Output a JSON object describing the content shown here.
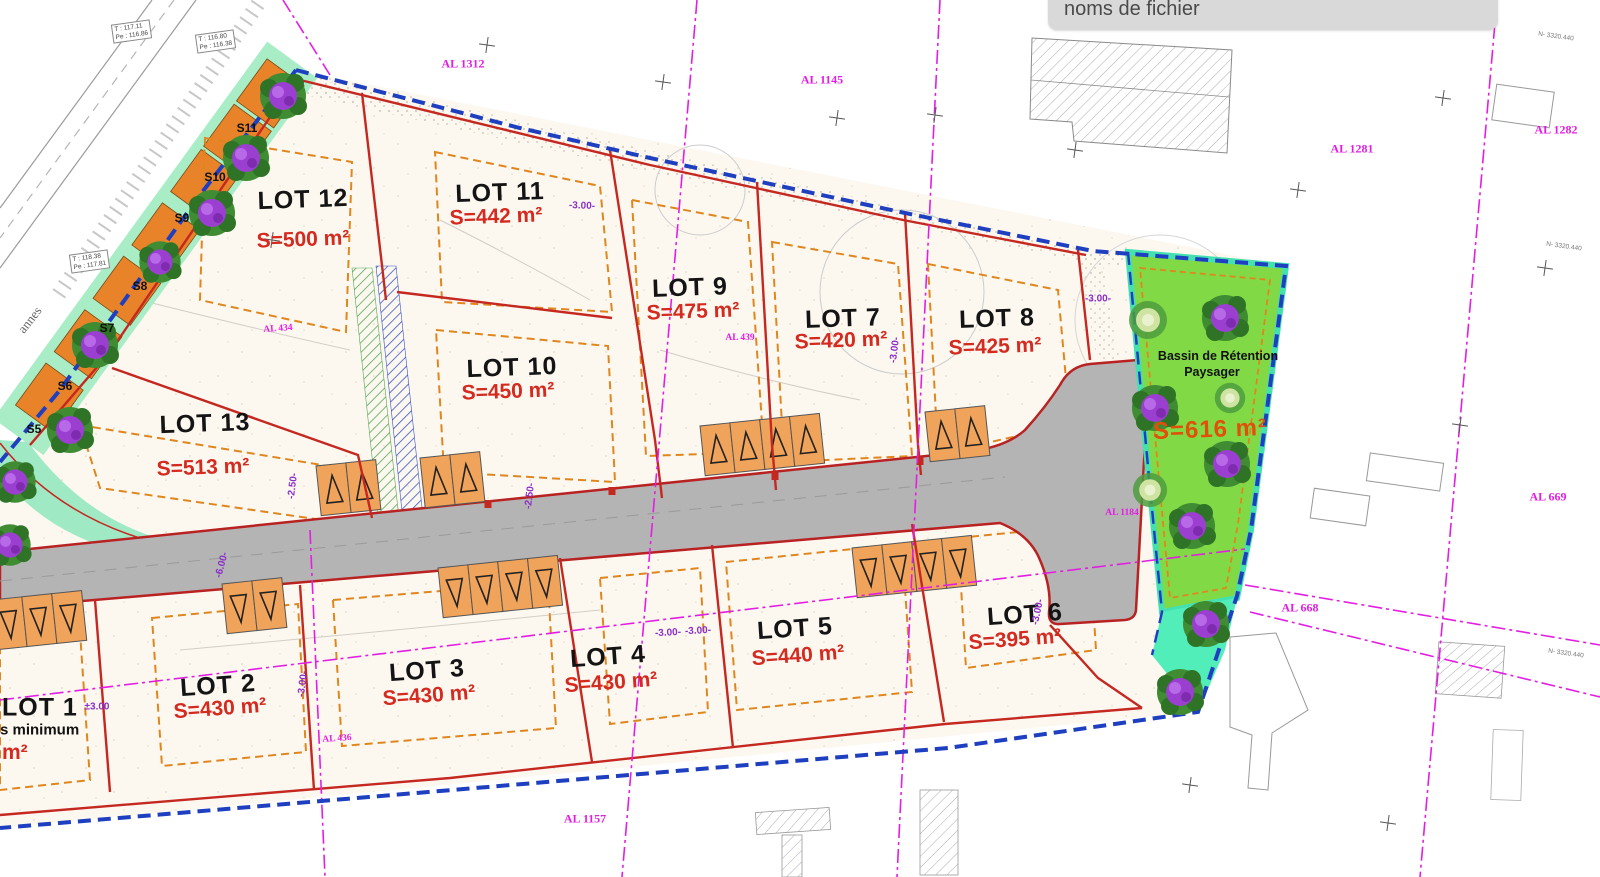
{
  "window": {
    "filename_field": "noms de fichier"
  },
  "plan": {
    "lots": [
      {
        "label": "LOT 1",
        "area": "m²",
        "note": "s minimum"
      },
      {
        "label": "LOT 2",
        "area": "S=430 m²"
      },
      {
        "label": "LOT 3",
        "area": "S=430 m²"
      },
      {
        "label": "LOT 4",
        "area": "S=430 m²"
      },
      {
        "label": "LOT 5",
        "area": "S=440 m²"
      },
      {
        "label": "LOT 6",
        "area": "S=395 m²"
      },
      {
        "label": "LOT 7",
        "area": "S=420 m²"
      },
      {
        "label": "LOT 8",
        "area": "S=425 m²"
      },
      {
        "label": "LOT 9",
        "area": "S=475 m²"
      },
      {
        "label": "LOT 10",
        "area": "S=450 m²"
      },
      {
        "label": "LOT 11",
        "area": "S=442 m²"
      },
      {
        "label": "LOT 12",
        "area": "S=500 m²"
      },
      {
        "label": "LOT 13",
        "area": "S=513 m²"
      }
    ],
    "basin": {
      "name_line1": "Bassin de Rétention",
      "name_line2": "Paysager",
      "area": "S=616 m²"
    },
    "parcels": [
      {
        "label": "AL 1312"
      },
      {
        "label": "AL 1145"
      },
      {
        "label": "AL 1281"
      },
      {
        "label": "AL 1282"
      },
      {
        "label": "AL 434"
      },
      {
        "label": "AL 439"
      },
      {
        "label": "AL 436"
      },
      {
        "label": "AL 1184"
      },
      {
        "label": "AL 668"
      },
      {
        "label": "AL 669"
      },
      {
        "label": "AL 1157"
      }
    ],
    "strip_sections": [
      "S5",
      "S6",
      "S7",
      "S8",
      "S9",
      "S10",
      "S11"
    ],
    "survey_tags": [
      {
        "line1": "T : 117.11",
        "line2": "Pe : 116.86"
      },
      {
        "line1": "T : 116.80",
        "line2": "Pe : 116.38"
      },
      {
        "line1": "T : 118.38",
        "line2": "Pe : 117.81"
      }
    ],
    "dims": {
      "d3": "-3.00-",
      "d25": "-2.50-",
      "pm3": "±3.00",
      "d6": "-6.00-"
    },
    "street_fragment": "annes",
    "coord_label": "N- 3320.440",
    "colors": {
      "lot_line_red": "#c42820",
      "cadastral_magenta": "#e31ee3",
      "boundary_blue": "#1e3fc0",
      "setback_orange": "#e0861e",
      "area_red": "#d42a20",
      "basin_green": "#82d946",
      "basin_teal": "#52eeba",
      "strip_orange": "#e8832a",
      "road_gray": "#b4b4b4",
      "dim_purple": "#8b2fc9",
      "basin_area_orange": "#e0500a"
    }
  }
}
